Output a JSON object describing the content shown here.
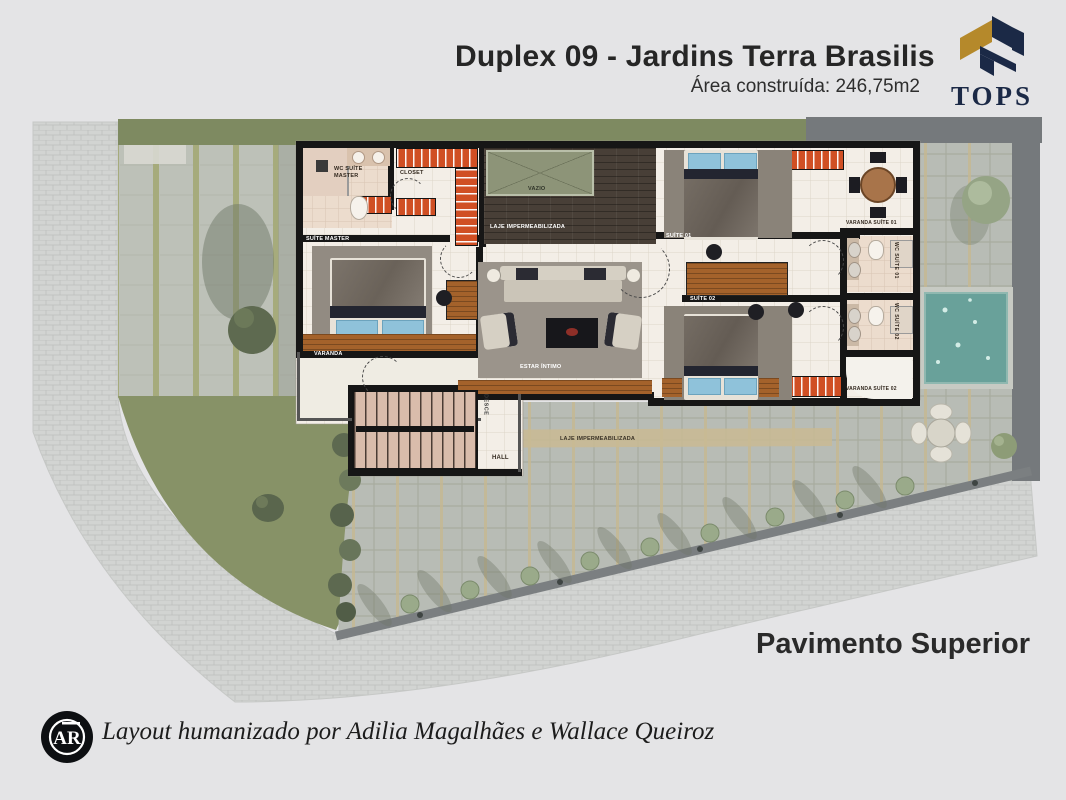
{
  "header": {
    "title": "Duplex 09 - Jardins Terra Brasilis",
    "subtitle": "Área construída: 246,75m2"
  },
  "brand": {
    "name": "TOPS",
    "navy": "#1b2946",
    "gold": "#b5892b"
  },
  "plan": {
    "floor_label": "Pavimento Superior",
    "labels": [
      {
        "id": "wc-suite-master",
        "text": "WC SUÍTE MASTER"
      },
      {
        "id": "closet",
        "text": "CLOSET"
      },
      {
        "id": "suite-master",
        "text": "SUÍTE MASTER"
      },
      {
        "id": "varanda",
        "text": "VARANDA"
      },
      {
        "id": "vazio",
        "text": "VAZIO"
      },
      {
        "id": "laje-impermeabilizada-1",
        "text": "LAJE IMPERMEABILIZADA"
      },
      {
        "id": "estar-intimo",
        "text": "ESTAR ÍNTIMO"
      },
      {
        "id": "desce",
        "text": "DESCE"
      },
      {
        "id": "hall",
        "text": "HALL"
      },
      {
        "id": "laje-impermeabilizada-2",
        "text": "LAJE IMPERMEABILIZADA"
      },
      {
        "id": "suite-01",
        "text": "SUÍTE 01"
      },
      {
        "id": "suite-02",
        "text": "SUÍTE 02"
      },
      {
        "id": "varanda-suite-01",
        "text": "VARANDA SUÍTE 01"
      },
      {
        "id": "wc-suite-01",
        "text": "WC SUÍTE 01"
      },
      {
        "id": "wc-suite-02",
        "text": "WC SUÍTE 02"
      },
      {
        "id": "varanda-suite-02",
        "text": "VARANDA SUÍTE 02"
      }
    ]
  },
  "footer": {
    "credit": "Layout humanizado por Adilia Magalhães e Wallace Queiroz",
    "logo_monogram": "AR"
  },
  "colors": {
    "background": "#e4e4e6",
    "wall": "#161616",
    "wardrobe_orange": "#d04f24",
    "pool_water": "#69a19a",
    "grass": "#879267"
  }
}
